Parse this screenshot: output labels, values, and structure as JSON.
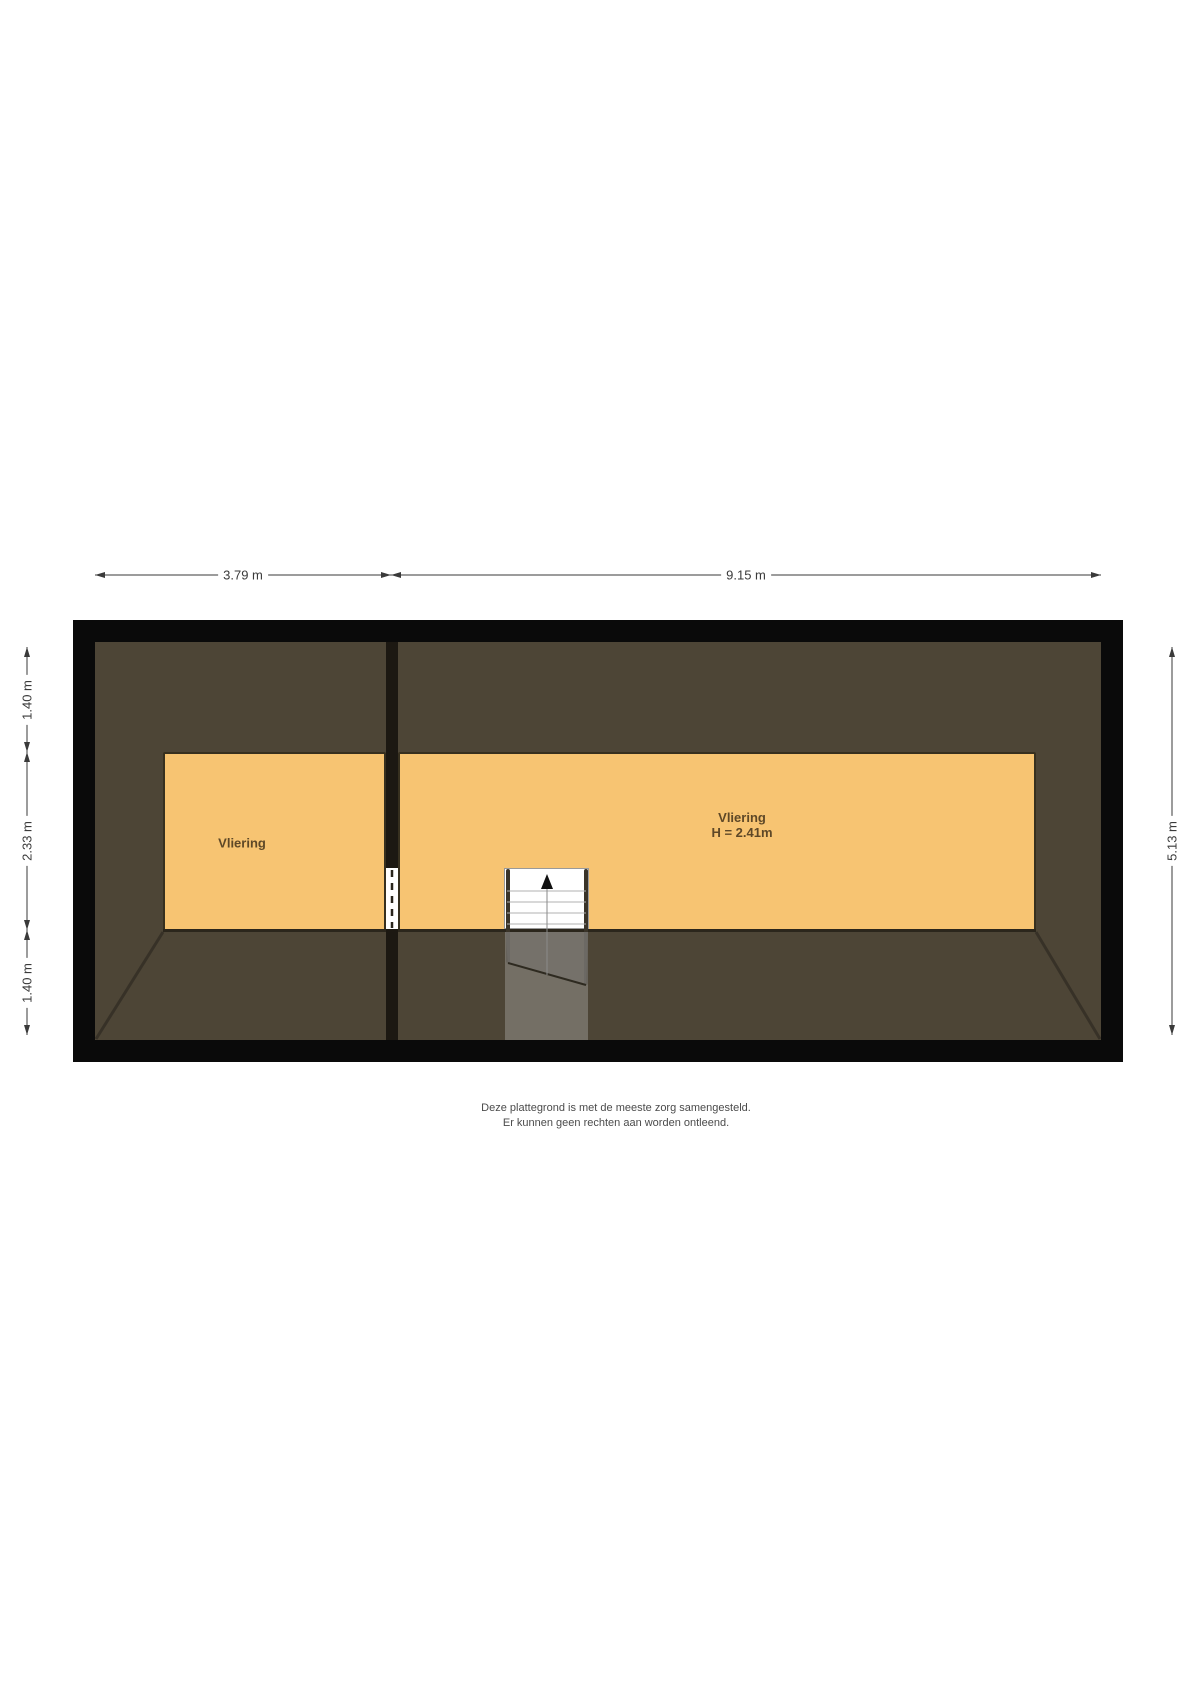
{
  "plan": {
    "type": "floorplan-attic",
    "rooms": [
      {
        "id": "left",
        "name": "Vliering"
      },
      {
        "id": "right",
        "name": "Vliering",
        "height_label": "H = 2.41m"
      }
    ],
    "colors": {
      "outer_wall": "#0a0a0a",
      "roof_area": "#4d4536",
      "room_fill": "#f7c472",
      "room_outline": "#37301f",
      "divider_wall": "#1c1812",
      "stair_fill": "#ffffff",
      "room_label_text": "#5e4827",
      "dimension_text": "#3a3a3a"
    }
  },
  "dimensions": {
    "top": [
      {
        "label": "3.79 m"
      },
      {
        "label": "9.15 m"
      }
    ],
    "left": [
      {
        "label": "1.40 m"
      },
      {
        "label": "2.33 m"
      },
      {
        "label": "1.40 m"
      }
    ],
    "right": [
      {
        "label": "5.13 m"
      }
    ]
  },
  "stairs": {
    "direction": "up"
  },
  "disclaimer": {
    "line1": "Deze plattegrond is met de meeste zorg samengesteld.",
    "line2": "Er kunnen geen rechten aan worden ontleend."
  }
}
